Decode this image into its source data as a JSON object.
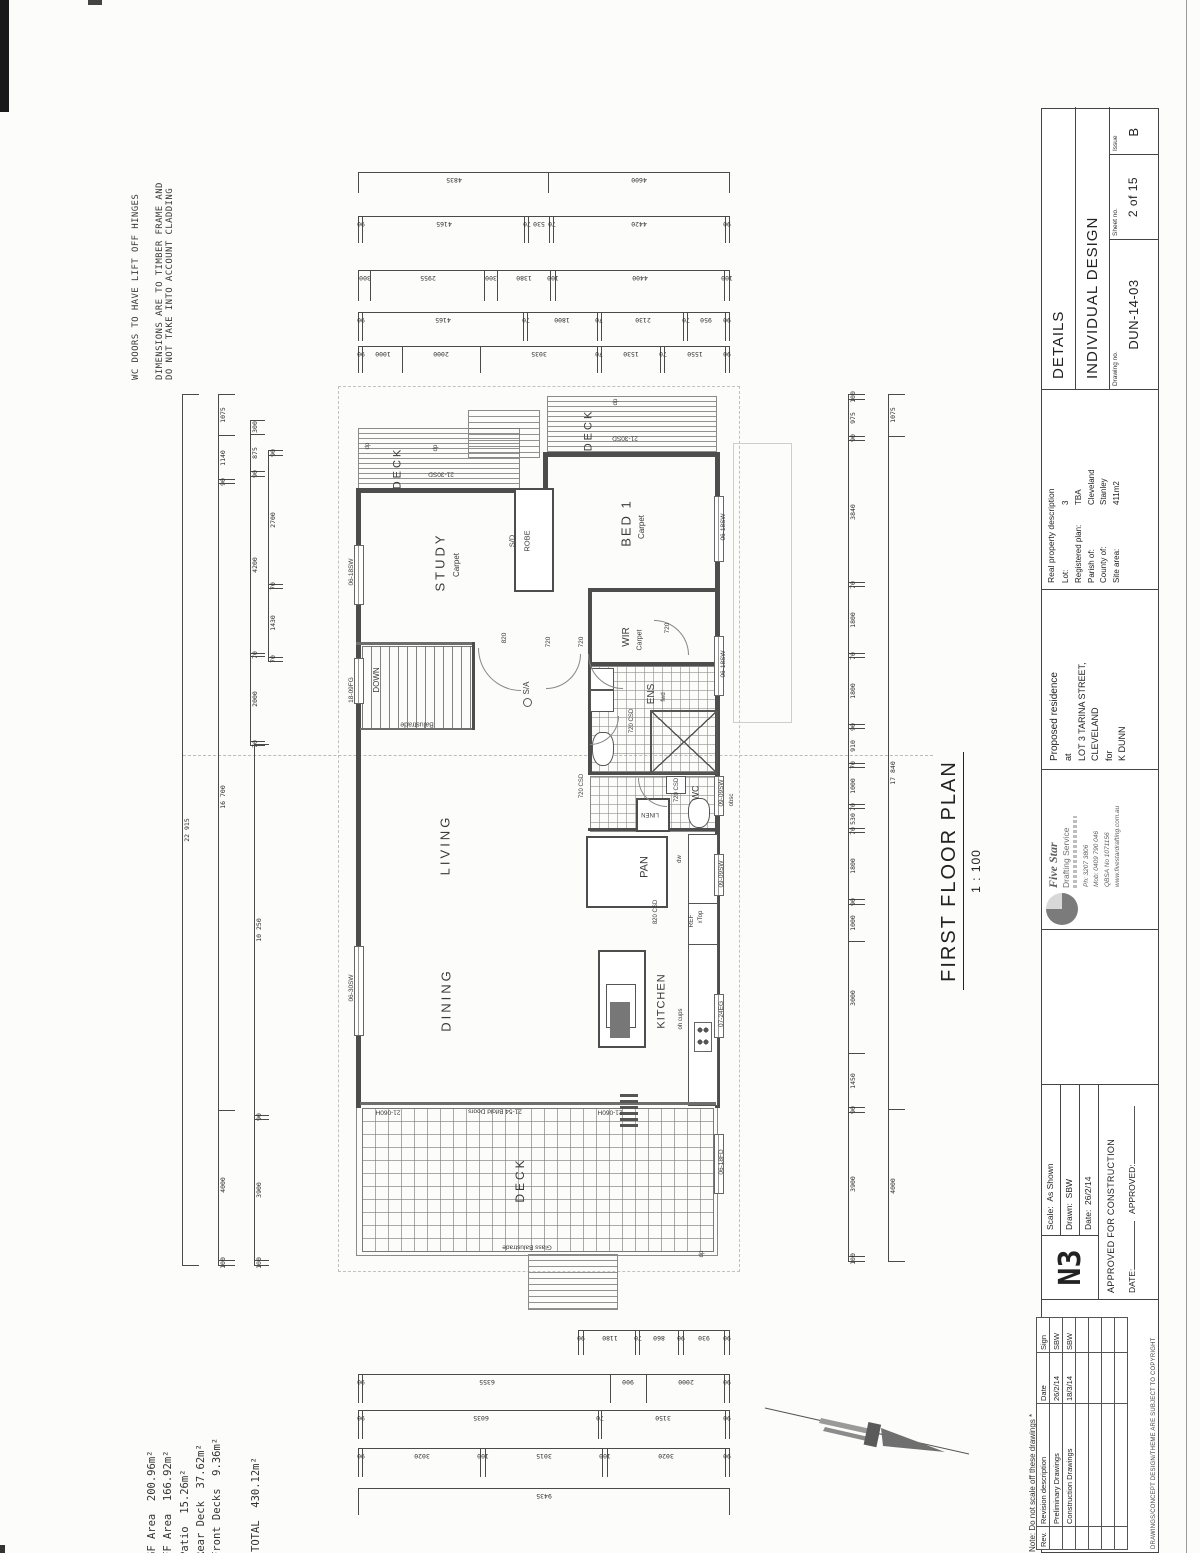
{
  "annotations": {
    "wc_note": "WC DOORS TO HAVE LIFT OFF HINGES",
    "dim_note_line1": "DIMENSIONS ARE TO TIMBER FRAME AND",
    "dim_note_line2": "DO NOT TAKE INTO ACCOUNT CLADDING",
    "areas": [
      "GF Area  200.96m²",
      "FF Area  166.92m²",
      "Patio  15.26m²",
      "Rear Deck  37.62m²",
      "Front Decks  9.36m²"
    ],
    "total": "TOTAL  430.12m²"
  },
  "plan_title": {
    "title": "FIRST FLOOR PLAN",
    "scale": "1 : 100"
  },
  "plan": {
    "labels": [
      {
        "t": "DECK",
        "x": 398,
        "y": 468,
        "r": -90,
        "s": 11,
        "sp": 3
      },
      {
        "t": "21-30SD",
        "x": 441,
        "y": 473,
        "r": 180,
        "s": 6.5
      },
      {
        "t": "DECK",
        "x": 589,
        "y": 430,
        "r": -90,
        "s": 11,
        "sp": 3
      },
      {
        "t": "21-30SD",
        "x": 625,
        "y": 437,
        "r": 180,
        "s": 6.5
      },
      {
        "t": "STUDY",
        "x": 440,
        "y": 562,
        "r": -90,
        "s": 13,
        "sp": 3
      },
      {
        "t": "Carpet",
        "x": 457,
        "y": 565,
        "r": -90,
        "s": 8
      },
      {
        "t": "S/D",
        "x": 512,
        "y": 541,
        "r": -90,
        "s": 7.5
      },
      {
        "t": "ROBE",
        "x": 527,
        "y": 541,
        "r": -90,
        "s": 7.5
      },
      {
        "t": "BED 1",
        "x": 626,
        "y": 523,
        "r": -90,
        "s": 13,
        "sp": 2
      },
      {
        "t": "Carpet",
        "x": 642,
        "y": 527,
        "r": -90,
        "s": 8
      },
      {
        "t": "WIR",
        "x": 627,
        "y": 637,
        "r": -90,
        "s": 10
      },
      {
        "t": "Carpet",
        "x": 640,
        "y": 640,
        "r": -90,
        "s": 7
      },
      {
        "t": "720",
        "x": 668,
        "y": 628,
        "r": -90,
        "s": 6.5
      },
      {
        "t": "ENS",
        "x": 652,
        "y": 694,
        "r": -90,
        "s": 10
      },
      {
        "t": "fwd",
        "x": 664,
        "y": 697,
        "r": -90,
        "s": 6
      },
      {
        "t": "DOWN",
        "x": 377,
        "y": 680,
        "r": -90,
        "s": 8
      },
      {
        "t": "Balustrade",
        "x": 417,
        "y": 724,
        "r": 180,
        "s": 7
      },
      {
        "t": "S/A",
        "x": 527,
        "y": 688,
        "r": -90,
        "s": 8
      },
      {
        "t": "820",
        "x": 505,
        "y": 638,
        "r": -90,
        "s": 6.5
      },
      {
        "t": "720",
        "x": 549,
        "y": 642,
        "r": -90,
        "s": 6.5
      },
      {
        "t": "720",
        "x": 582,
        "y": 642,
        "r": -90,
        "s": 6.5
      },
      {
        "t": "720 CSD",
        "x": 632,
        "y": 721,
        "r": -90,
        "s": 6
      },
      {
        "t": "720 CSD",
        "x": 582,
        "y": 786,
        "r": -90,
        "s": 6
      },
      {
        "t": "720 CSD",
        "x": 677,
        "y": 790,
        "r": -90,
        "s": 6
      },
      {
        "t": "WC",
        "x": 696,
        "y": 793,
        "r": -90,
        "s": 9
      },
      {
        "t": "LINEN",
        "x": 650,
        "y": 814,
        "r": 180,
        "s": 6
      },
      {
        "t": "LIVING",
        "x": 445,
        "y": 845,
        "r": -90,
        "s": 13,
        "sp": 3
      },
      {
        "t": "PAN",
        "x": 645,
        "y": 867,
        "r": -90,
        "s": 11
      },
      {
        "t": "dw",
        "x": 680,
        "y": 859,
        "r": -90,
        "s": 6
      },
      {
        "t": "820 CSD",
        "x": 656,
        "y": 912,
        "r": -90,
        "s": 6
      },
      {
        "t": "REF",
        "x": 692,
        "y": 921,
        "r": -90,
        "s": 6.5
      },
      {
        "t": "xTop",
        "x": 701,
        "y": 917,
        "r": -90,
        "s": 6
      },
      {
        "t": "DINING",
        "x": 446,
        "y": 1000,
        "r": -90,
        "s": 13,
        "sp": 3
      },
      {
        "t": "KITCHEN",
        "x": 662,
        "y": 1001,
        "r": -90,
        "s": 11,
        "sp": 1
      },
      {
        "t": "oh cups",
        "x": 681,
        "y": 1019,
        "r": -90,
        "s": 6
      },
      {
        "t": "DECK",
        "x": 520,
        "y": 1180,
        "r": -90,
        "s": 12,
        "sp": 3
      },
      {
        "t": "21-54 Bifold Doors",
        "x": 495,
        "y": 1110,
        "r": 180,
        "s": 6.5
      },
      {
        "t": "21-060H",
        "x": 610,
        "y": 1111,
        "r": 180,
        "s": 6.5
      },
      {
        "t": "21-060H",
        "x": 388,
        "y": 1111,
        "r": 180,
        "s": 6.5
      },
      {
        "t": "Glass Balustrade",
        "x": 527,
        "y": 1246,
        "r": 180,
        "s": 6.5
      },
      {
        "t": "dp",
        "x": 368,
        "y": 446,
        "r": -90,
        "s": 6
      },
      {
        "t": "dp",
        "x": 436,
        "y": 448,
        "r": -90,
        "s": 6
      },
      {
        "t": "dp",
        "x": 616,
        "y": 402,
        "r": -90,
        "s": 6
      },
      {
        "t": "dp",
        "x": 702,
        "y": 1254,
        "r": -90,
        "s": 6
      },
      {
        "t": "06-18SW",
        "x": 352,
        "y": 572,
        "r": -90,
        "s": 6.5
      },
      {
        "t": "18-09FG",
        "x": 352,
        "y": 690,
        "r": -90,
        "s": 6.5
      },
      {
        "t": "06-30SW",
        "x": 352,
        "y": 988,
        "r": -90,
        "s": 6.5
      },
      {
        "t": "06-18SW",
        "x": 724,
        "y": 527,
        "r": -90,
        "s": 6.5
      },
      {
        "t": "06-18SW",
        "x": 724,
        "y": 664,
        "r": -90,
        "s": 6.5
      },
      {
        "t": "09-09SW",
        "x": 722,
        "y": 793,
        "r": -90,
        "s": 6.5
      },
      {
        "t": "obsc",
        "x": 732,
        "y": 800,
        "r": -90,
        "s": 6
      },
      {
        "t": "09-09SW",
        "x": 722,
        "y": 874,
        "r": -90,
        "s": 6.5
      },
      {
        "t": "07-24EG",
        "x": 722,
        "y": 1014,
        "r": -90,
        "s": 6.5
      },
      {
        "t": "06-18FD",
        "x": 722,
        "y": 1162,
        "r": -90,
        "s": 6.5
      }
    ]
  },
  "dimensions": {
    "t1": [
      "4835",
      "4600"
    ],
    "t2": [
      "90",
      "4165",
      "70",
      "530",
      "70",
      "4420",
      "90"
    ],
    "t3": [
      "300",
      "2955",
      "300",
      "1380",
      "100",
      "4400",
      "100"
    ],
    "t4": [
      "90",
      "4165",
      "70",
      "1800",
      "70",
      "2130",
      "70",
      "950",
      "90"
    ],
    "t5": [
      "90",
      "1000",
      "2000",
      "3035",
      "70",
      "1530",
      "70",
      "1550",
      "90"
    ],
    "b1": [
      "90",
      "1180",
      "70",
      "860",
      "90",
      "930",
      "90"
    ],
    "b2": [
      "90",
      "6355",
      "900",
      "2000",
      "90"
    ],
    "b3": [
      "90",
      "6035",
      "70",
      "3150",
      "90"
    ],
    "b4": [
      "90",
      "3020",
      "100",
      "3015",
      "100",
      "3020",
      "90"
    ],
    "b5": [
      "9435"
    ],
    "L1": [
      "22 915"
    ],
    "L2": [
      "1075",
      "1140",
      "90",
      "16 700",
      "4000",
      "100"
    ],
    "L3": [
      "300",
      "875",
      "90",
      "4200",
      "70",
      "2000",
      "70"
    ],
    "L4": [
      "90",
      "2700",
      "70",
      "1430",
      "70"
    ],
    "L5": [
      "10 250",
      "90",
      "3900",
      "100"
    ],
    "R1": [
      "100",
      "975",
      "90",
      "3840",
      "70",
      "1800",
      "70",
      "1800",
      "90",
      "910",
      "70",
      "1000",
      "70",
      "530",
      "70",
      "1800",
      "90",
      "1000",
      "3000",
      "1450",
      "90",
      "3900",
      "100"
    ],
    "R2": [
      "1075",
      "17 840",
      "4000"
    ]
  },
  "title_block": {
    "note": "Note: Do not scale off these drawings *",
    "copyright": "DRAWINGS/CONCEPT DESIGN/THEME ARE SUBJECT TO COPYRIGHT",
    "revision_table": {
      "headers": [
        "Rev.",
        "Revision description",
        "Date",
        "Sign"
      ],
      "rows": [
        [
          "",
          "Preliminary Drawings",
          "26/2/14",
          "SBW"
        ],
        [
          "",
          "Construction Drawings",
          "18/3/14",
          "SBW"
        ],
        [
          "",
          "",
          "",
          ""
        ],
        [
          "",
          "",
          "",
          ""
        ],
        [
          "",
          "",
          "",
          ""
        ],
        [
          "",
          "",
          "",
          ""
        ]
      ]
    },
    "stamp": {
      "code": "N3",
      "scale_label": "Scale:",
      "scale": "As Shown",
      "drawn_label": "Drawn:",
      "drawn": "SBW",
      "date_label": "Date:",
      "date": "26/2/14",
      "approved_text": "APPROVED FOR CONSTRUCTION",
      "date_line_label": "DATE:",
      "approved_line_label": "APPROVED:"
    },
    "firm": {
      "name": "Five Star",
      "name2": "Drafting Service",
      "contact": [
        "Ph: 3207 3806",
        "Mob: 0409 790 046",
        "QBSA No 1071156",
        "www.fivestardrafting.com.au"
      ]
    },
    "project": {
      "lines": [
        "Proposed residence",
        "at",
        "LOT 3 TARINA STREET,",
        "CLEVELAND",
        "for",
        "K DUNN"
      ]
    },
    "property": {
      "header": "Real property description",
      "fields": [
        [
          "Lot:",
          "3"
        ],
        [
          "Registered plan:",
          "TBA"
        ],
        [
          "Parish of:",
          "Cleveland"
        ],
        [
          "County of:",
          "Stanley"
        ],
        [
          "Site area:",
          "411m2"
        ]
      ]
    },
    "details": {
      "row1": "DETAILS",
      "row2": "INDIVIDUAL DESIGN",
      "drawing_no_label": "Drawing no.",
      "drawing_no": "DUN-14-03",
      "sheet_label": "Sheet no.",
      "sheet": "2 of 15",
      "issue_label": "Issue",
      "issue": "B"
    }
  }
}
